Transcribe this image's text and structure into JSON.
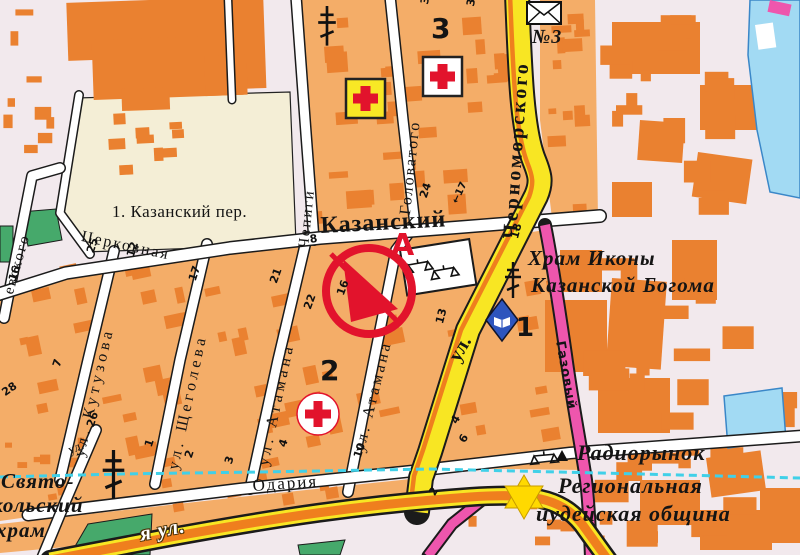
{
  "labels": {
    "kazansky_per": "1. Казанский пер.",
    "kazansky": "Казанский",
    "tserkovnaya": "Церковная",
    "chepigi": "Чепиги",
    "golovatogo": "Головатого",
    "chernomorskogo": "Черноморского",
    "ul_prefix": "ул.",
    "kutuzova": "ул. Кутузова",
    "shchegoleva": "ул. Щеголева",
    "atamana": "ул. Атамана",
    "atamana2": "ул. Атамана",
    "gazovy": "Газовый",
    "odariya": "Одария",
    "levsky_partial": "евского",
    "highway_partial": "я ул.",
    "ul_small": "ул.",
    "hram_line1": "Храм Иконы",
    "hram_line2": "Казанской Богома",
    "radiorynok": "Радиорынок",
    "regionalnaya": "Региональная",
    "iudeyskaya": "иудейская община",
    "svyato_line1": "Свято-",
    "svyato_line2": "кольский",
    "svyato_line3": "храм",
    "post_no": "№3",
    "district_3": "3",
    "district_2": "2",
    "district_1": "1",
    "marker_letter": "А"
  },
  "hn": [
    "34",
    "39",
    "24",
    "←17",
    "8",
    "22",
    "21",
    "16",
    "13",
    "18",
    "25",
    "12",
    "17",
    "16",
    "28",
    "7",
    "26",
    "1",
    "2",
    "3",
    "4",
    "10",
    "4",
    "6",
    "2"
  ],
  "icons": {
    "pharmacy_cross": "red-cross-yellow-square",
    "hospital_cross": "red-cross-white-square",
    "hospital_cross_round": "red-cross-white-circle",
    "church_cross": "orthodox-cross",
    "post_envelope": "envelope",
    "library": "blue-diamond-open-book",
    "synagogue_star": "star-of-david",
    "market": "scales-triangles",
    "route_marker": "red-circle-arrow",
    "tram_line": "cyan-dashed-line"
  },
  "colors": {
    "background": "#f2e9ed",
    "block": "#f4ad68",
    "building": "#ea8130",
    "open_square": "#f4eed6",
    "road_minor": "#ffffff",
    "road_yellow": "#f8e623",
    "road_orange": "#ef7f1e",
    "road_pink": "#ee56ad",
    "water": "#a2daf3",
    "park": "#46a96b",
    "route_line": "#40d0e8",
    "red": "#e2132c",
    "library_blue": "#2e55bd",
    "star_yellow": "#ffd900",
    "ink": "#1b1b1b"
  }
}
